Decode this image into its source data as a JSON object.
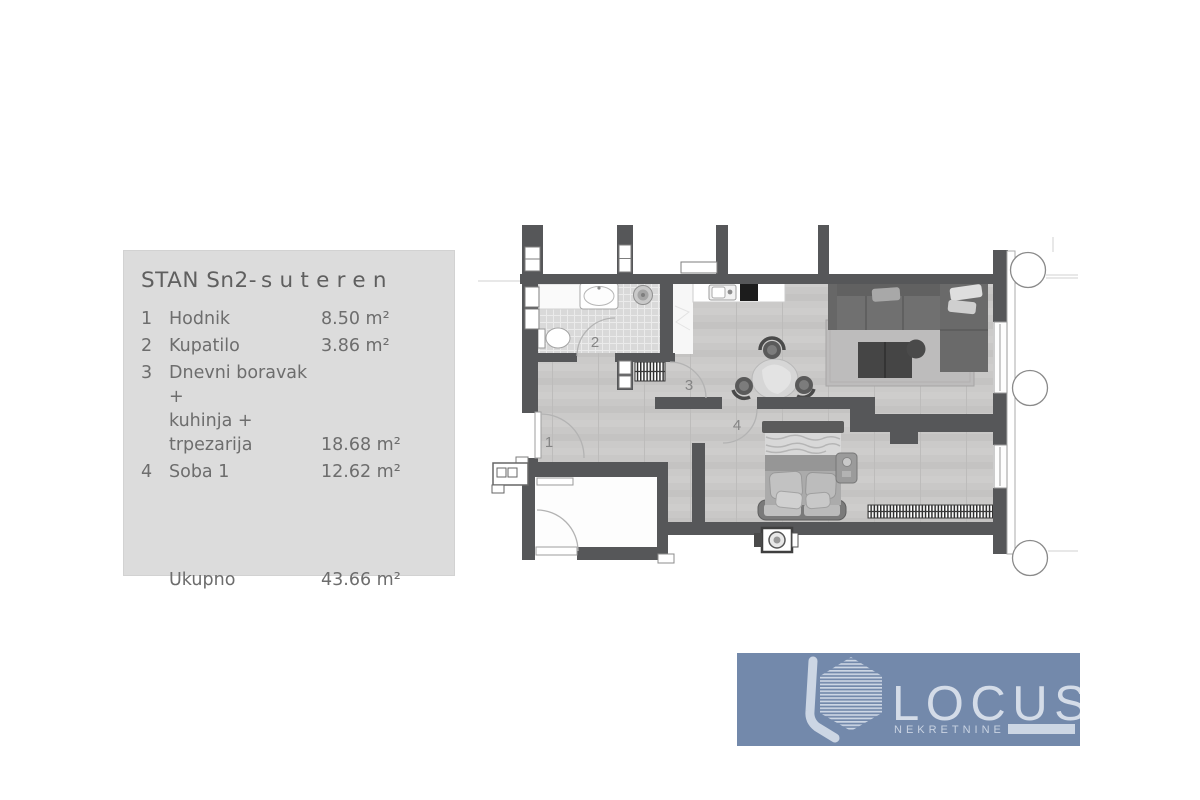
{
  "panel": {
    "title_main": "STAN Sn2-",
    "title_spaced": "suteren",
    "rooms": [
      {
        "num": "1",
        "name": "Hodnik",
        "area": "8.50 m²"
      },
      {
        "num": "2",
        "name": "Kupatilo",
        "area": "3.86 m²"
      },
      {
        "num": "3",
        "name": "Dnevni boravak +\nkuhinja + trpezarija",
        "area": "18.68 m²"
      },
      {
        "num": "4",
        "name": "Soba 1",
        "area": "12.62 m²"
      }
    ],
    "total_label": "Ukupno",
    "total_area": "43.66 m²",
    "bg": "#dcdcdc",
    "text_color": "#6d6d6d"
  },
  "plan": {
    "labels": {
      "hallway": "1",
      "bathroom": "2",
      "living": "3",
      "bedroom": "4"
    },
    "colors": {
      "wall": "#565759",
      "floor_wood": "#c9c8c7",
      "tile": "#d9d9d9",
      "rug": "#bdbcbc",
      "sofa": "#6d6d6d",
      "label": "#858585"
    }
  },
  "logo": {
    "name": "LOCUS",
    "subtitle": "NEKRETNINE",
    "bg": "#7389ab",
    "fg": "#d4dce8",
    "fg_soft": "#c9d3e2"
  }
}
